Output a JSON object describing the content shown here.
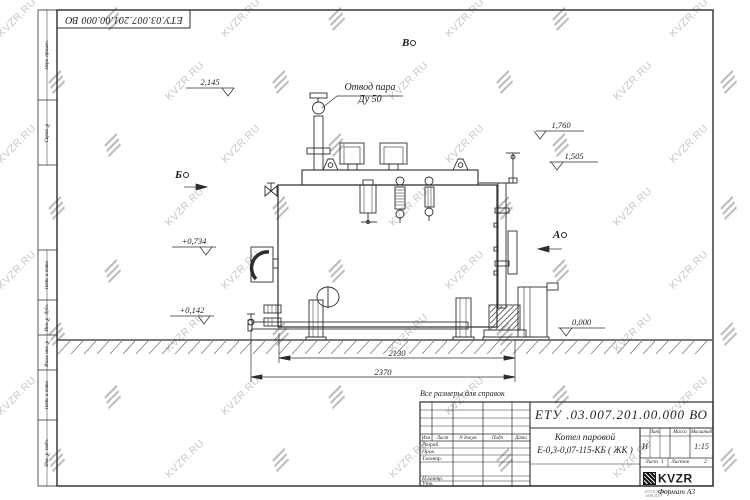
{
  "watermark": {
    "text": "KVZR.RU"
  },
  "corner_stamp": {
    "doc_number": "ЕТУ.03.007.201.00.000  ВО"
  },
  "margin_labels": [
    "Перв. примен.",
    "Справ. №",
    "Подп. и дата",
    "Инв. № дубл.",
    "Взам. инв. №",
    "Подп. и дата",
    "Инв. № подл."
  ],
  "drawing": {
    "steam_outlet": {
      "line1": "Отвод пара",
      "line2": "Ду 50"
    },
    "views": {
      "b": "В",
      "b_side": "Б",
      "a": "А"
    },
    "elevations": {
      "top": "2,145",
      "right_upper": "1,760",
      "right_lower": "1,505",
      "left_upper": "+0,734",
      "left_lower": "+0,142",
      "ground": "0,000"
    },
    "dimensions": {
      "inner": "2130",
      "outer": "2370"
    },
    "note": "Все размеры для справок"
  },
  "title_block": {
    "doc_number": "ЕТУ .03.007.201.00.000  ВО",
    "product_name_line1": "Котел паровой",
    "product_name_line2": "Е-0,3-0,07-115-КБ ( ЖК )",
    "change_header": [
      "Изм",
      "Лист",
      "N докум",
      "Подп",
      "Дата"
    ],
    "sign_labels": [
      "Разраб.",
      "Пров.",
      "Т.контр.",
      "Н.контр.",
      "Утв."
    ],
    "lit_label": "Лит.",
    "mass_label": "Масса",
    "scale_label": "Масштаб",
    "lit_value": "И",
    "scale_value": "1:15",
    "sheet_label": "Лист",
    "sheet_value": "1",
    "sheets_label": "Листов",
    "sheets_value": "2",
    "logo_text": "KVZR",
    "logo_caption_line1": "КОТЕЛЬНЫЙ",
    "logo_caption_line2": "ЗАВОД.РУ",
    "format_label": "Формат А3"
  }
}
